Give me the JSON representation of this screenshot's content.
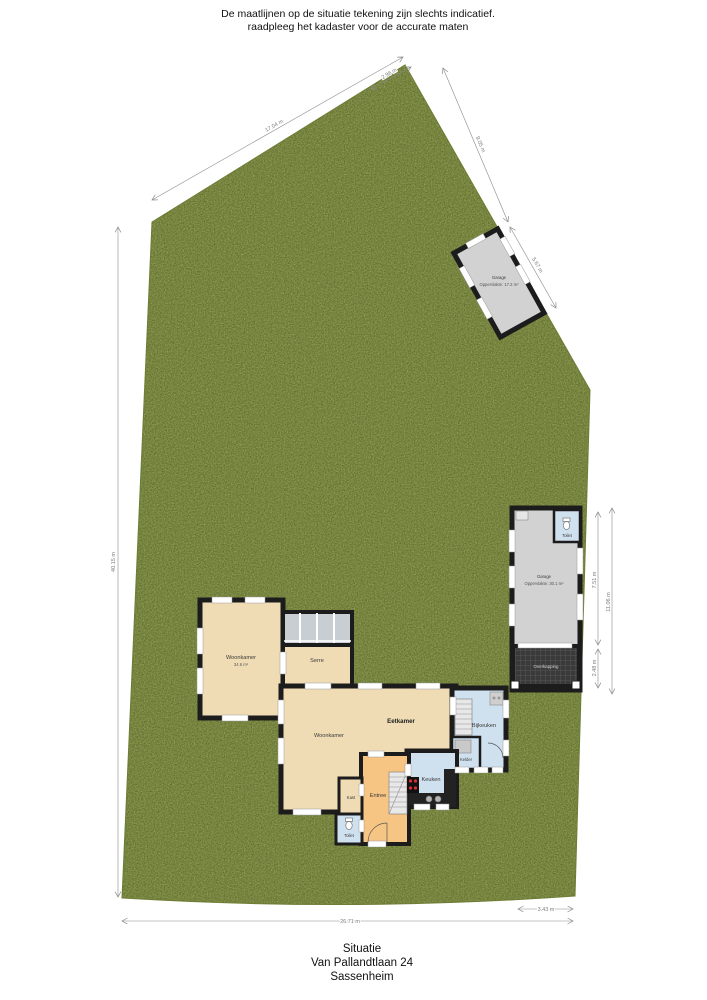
{
  "header": {
    "line1": "De maatlijnen op de situatie tekening zijn slechts indicatief.",
    "line2": "raadpleeg het kadaster voor de accurate maten"
  },
  "footer": {
    "title": "Situatie",
    "address": "Van Pallandtlaan 24",
    "city": "Sassenheim"
  },
  "rooms": {
    "woonkamer_wing": {
      "label": "Woonkamer",
      "sub": "34.6 m²"
    },
    "serre": {
      "label": "Serre"
    },
    "eetkamer": {
      "label": "Eetkamer"
    },
    "woonkamer": {
      "label": "Woonkamer"
    },
    "bijkeuken": {
      "label": "Bijkeuken"
    },
    "kelder": {
      "label": "Kelder"
    },
    "keuken": {
      "label": "Keuken"
    },
    "entree": {
      "label": "Entree"
    },
    "kast": {
      "label": "Kast"
    },
    "toilet": {
      "label": "Toilet"
    }
  },
  "outbuildings": {
    "garage_top": {
      "label": "Garage",
      "sub": "Oppervlakte: 17.2 m²"
    },
    "garage_right": {
      "label": "Garage",
      "sub": "Oppervlakte: 30.1 m²"
    },
    "garage_toilet": {
      "label": "Toilet"
    },
    "overkapping": {
      "label": "Overkapping"
    }
  },
  "dimensions": {
    "left_side": "40.15 m",
    "bottom": "26.71 m",
    "bottom_right": "3.43 m",
    "top_left_edge": "17.04 m",
    "top_apex": "2.96 m",
    "top_right_upper": "9.05 m",
    "top_right_lower": "5.67 m",
    "garage_length": "7.51 m",
    "overkapping_length": "2.48 m",
    "right_outer": "11.06 m"
  },
  "colors": {
    "grass": "#7b8c3c",
    "wall": "#1c1c1c",
    "room_beige": "#efdcb4",
    "room_orange": "#f6c583",
    "room_blue": "#cfe0ee",
    "garage_gray": "#d2d2d2",
    "glass_gray": "#c9ced3",
    "stove_red": "#d92f2f"
  }
}
